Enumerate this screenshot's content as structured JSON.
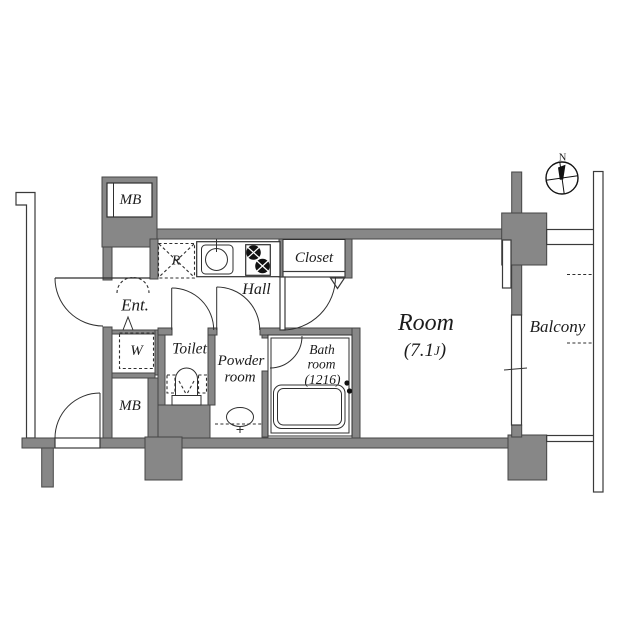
{
  "palette": {
    "wall_fill": "#878787",
    "wall_outline": "#454545",
    "line": "#2f2f2f",
    "text": "#1c1c1c",
    "background": "#ffffff"
  },
  "compass": {
    "north_label": "N"
  },
  "labels": {
    "mb_top": "MB",
    "refrigerator": "R",
    "hall": "Hall",
    "closet": "Closet",
    "entrance": "Ent.",
    "washer": "W",
    "toilet": "Toilet",
    "powder_line1": "Powder",
    "powder_line2": "room",
    "bath_line1": "Bath",
    "bath_line2": "room",
    "bath_line3": "(1216)",
    "room_name": "Room",
    "room_size_open": "(7.1",
    "room_size_unit": "J",
    "room_size_close": ")",
    "balcony": "Balcony",
    "mb_bottom": "MB"
  }
}
